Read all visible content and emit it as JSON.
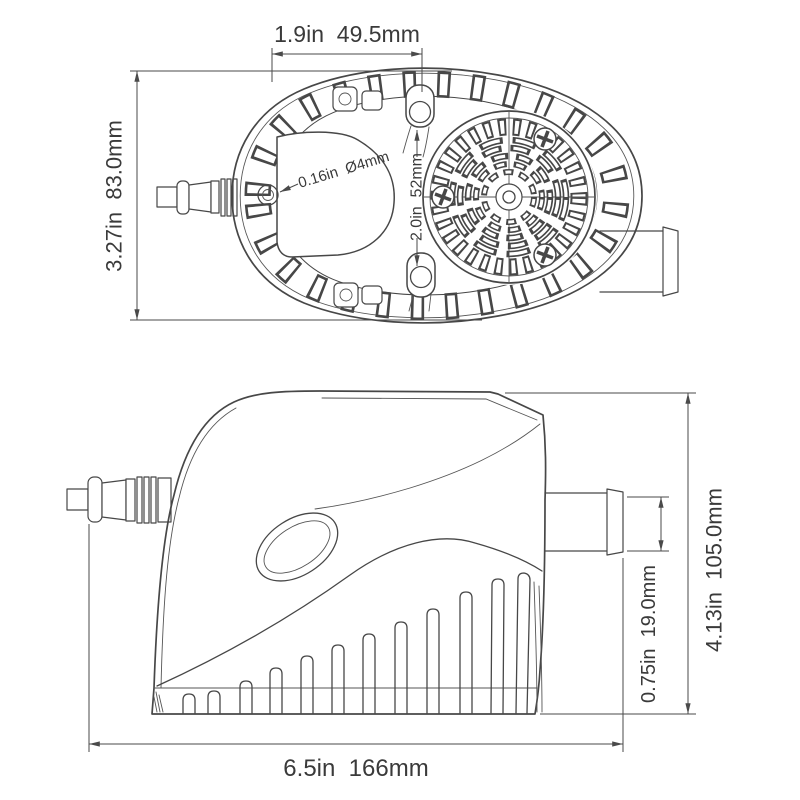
{
  "page": {
    "background": "#ffffff"
  },
  "drawing": {
    "line_color": "#474747",
    "dimension_color": "#4a4a4a",
    "text_color": "#3a3a3a",
    "subject": "bilge pump dimension drawing"
  },
  "top_view": {
    "dims": {
      "width": "1.9in  49.5mm",
      "height": "3.27in  83.0mm",
      "mount_span": "2.0in  52mm",
      "hole": "0.16in  Ø4mm"
    }
  },
  "side_view": {
    "dims": {
      "height": "4.13in  105.0mm",
      "outlet": "0.75in  19.0mm",
      "length": "6.5in  166mm"
    }
  }
}
